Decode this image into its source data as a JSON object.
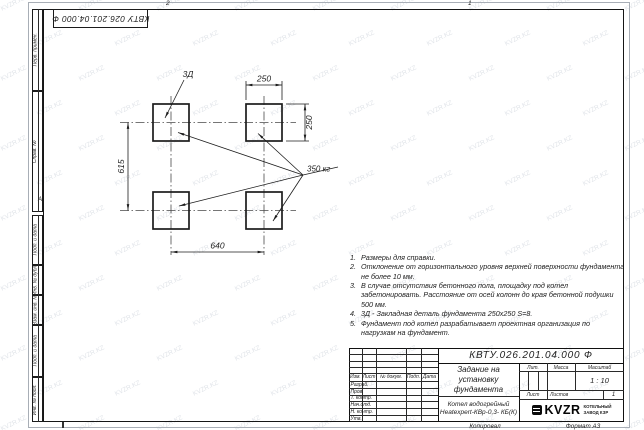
{
  "watermark": {
    "text": "KVZR.KZ"
  },
  "frame": {
    "stamp_top": "КВТУ 026.201.04.000 Ф",
    "zone_top_left": "2",
    "zone_top_right": "1",
    "zone_row_marker": "А",
    "margin_upper": {
      "b0": "Перв. примен.",
      "b1": "Справ. №"
    },
    "margin_lower": {
      "b0": "Подп. и дата",
      "b1": "Инв. № дубл.",
      "b2": "Взам. инв. №",
      "b3": "Подп. и дата",
      "b4": "Инв. № подл."
    }
  },
  "drawing": {
    "dim_top": "250",
    "dim_right": "250",
    "dim_left": "615",
    "dim_bottom": "640",
    "detail_label": "3Д",
    "load_label": "350 кг"
  },
  "notes": {
    "n1": {
      "num": "1.",
      "text": "Размеры для справки."
    },
    "n2": {
      "num": "2.",
      "text": "Отклонение от горизонтального уровня верхней поверхности фундамента не более 10 мм."
    },
    "n3": {
      "num": "3.",
      "text": "В случае отсутствия бетонного пола, площадку под котел забетонировать. Расстояние от осей колонн до края бетонной подушки 500 мм."
    },
    "n4": {
      "num": "4.",
      "text": "3Д - Закладная деталь фундамента 250х250 S=8."
    },
    "n5": {
      "num": "5.",
      "text": "Фундамент под котел разрабатывает проектная организация по нагрузкам на фундамент."
    }
  },
  "title_block": {
    "doc_number": "КВТУ.026.201.04.000 Ф",
    "title_line1": "Задание на установку",
    "title_line2": "фундамента",
    "product_line1": "Котел водогрейный",
    "product_line2": "Heatexpert-КВр-0,3- КБ(К)",
    "cols": {
      "izm": "Изм.",
      "list": "Лист",
      "docnum": "№ докум.",
      "podp": "Подп.",
      "data": "Дата"
    },
    "rows": {
      "r0": "Разраб.",
      "r1": "Пров.",
      "r2": "Т. контр.",
      "r3": "Нач.отд.",
      "r4": "Н. контр.",
      "r5": "Утв."
    },
    "lit_label": "Лит.",
    "mass_label": "Масса",
    "scale_label": "Масштаб",
    "scale_value": "1 : 10",
    "sheet_label": "Лист",
    "sheets_label": "Листов",
    "sheets_value": "1",
    "logo_text": "KVZR",
    "org_line1": "КОТЕЛЬНЫЙ",
    "org_line2": "ЗАВОД КЗР",
    "footer_copied": "Копировал",
    "footer_format": "Формат А3"
  }
}
